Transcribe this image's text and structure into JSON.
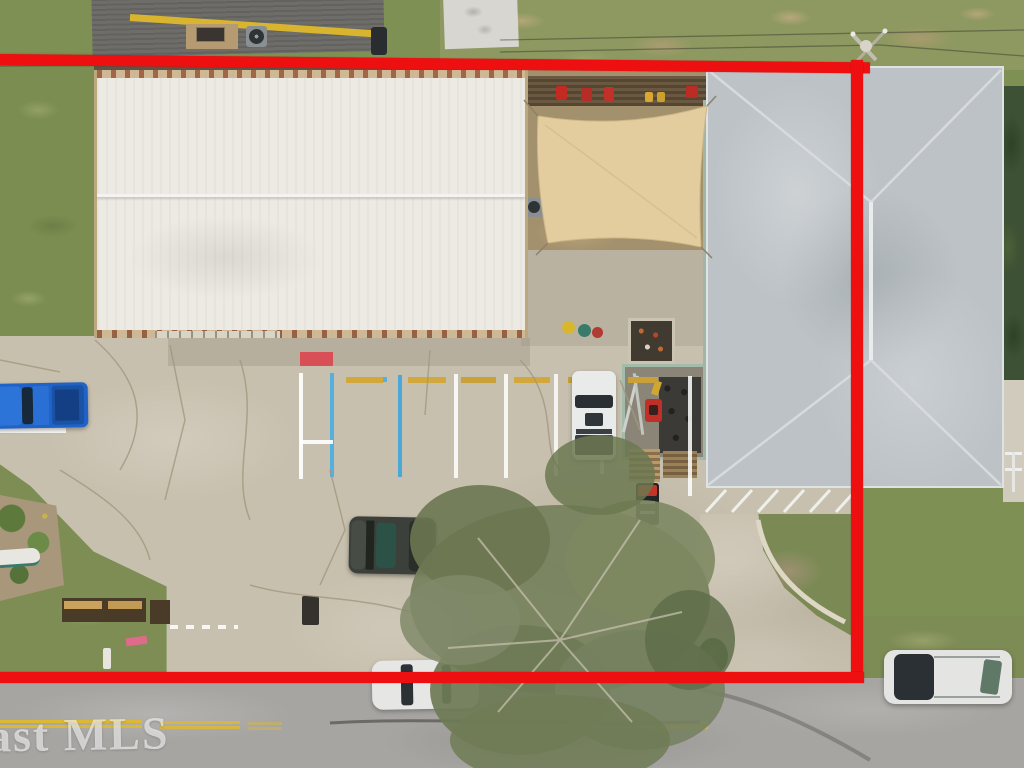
{
  "scene": {
    "type": "aerial-property-photo",
    "watermark_text": "ast MLS"
  },
  "boundary": {
    "color": "#ee1010",
    "visible_edges": "top, right and bottom property lines drawn over photo"
  },
  "colors": {
    "grass": "#7f9055",
    "field_grass": "#8d9960",
    "dark_trees": "#3d5134",
    "concrete": "#c8c0ae",
    "road": "#a7a5a2",
    "road_centerline_yellow": "#ddb832",
    "warehouse_roof_white": "#eceae3",
    "metal_roof_gray": "#bcc2c6",
    "shade_sail_tan": "#e3cd9f",
    "pickup_blue": "#2268cc",
    "pickup_white": "#e9ebea",
    "suv_dark": "#3b403a",
    "suv_white": "#e4e5e3",
    "stripe_blue": "#55b0e0",
    "wheel_stop_yellow": "#d2a83c",
    "painted_mark_red": "#d85055"
  },
  "objects": {
    "buildings": [
      "white-warehouse-roof",
      "gray-metal-hip-roof-building",
      "neighbor-house-roof"
    ],
    "vehicles": [
      "blue-pickup-truck",
      "white-pickup-truck",
      "dark-suv",
      "white-car-on-street",
      "white-suv-on-street"
    ],
    "site_features": [
      "shade-sail",
      "equipment-yard",
      "pallets",
      "parking-stalls",
      "oak-tree-canopy",
      "utility-pole",
      "street-with-double-yellow-line"
    ]
  }
}
